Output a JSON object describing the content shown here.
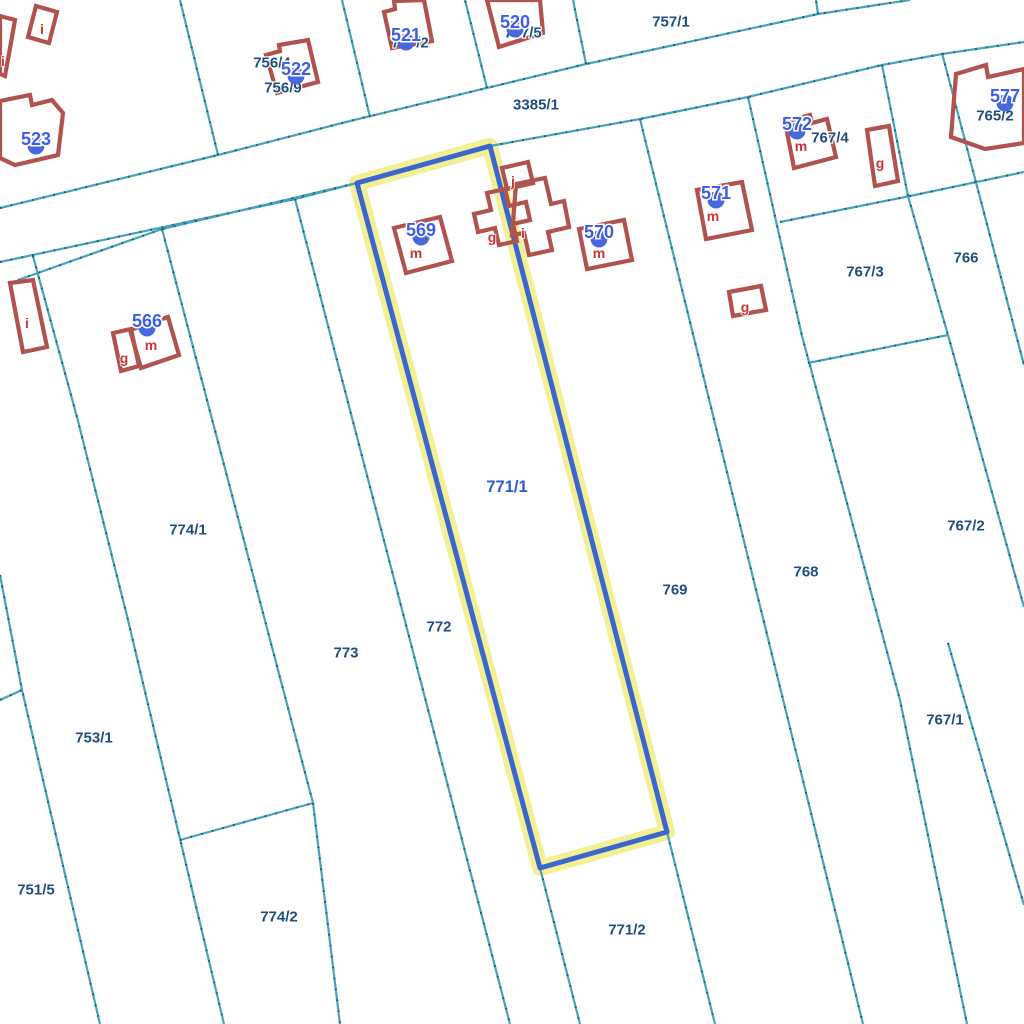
{
  "map": {
    "selected_parcel": "771/1",
    "colors": {
      "background": "#ffffff",
      "boundary": "#45a3bd",
      "boundary_speckle": "#104955",
      "building_stroke": "#b0524e",
      "letter_red": "#cc3434",
      "parcel_navy": "#1e4e7e",
      "selected_label_blue": "#2e5ad2",
      "house_number_blue": "#3e5de2",
      "house_marker_blue": "#4868e0",
      "highlight_blue": "#3a67cf",
      "highlight_halo": "#f2ee8f"
    },
    "highlight": {
      "parcel": "771/1",
      "points": [
        [
          357,
          183
        ],
        [
          490,
          146
        ],
        [
          667,
          832
        ],
        [
          540,
          868
        ]
      ]
    },
    "lines": [
      {
        "name": "road-top-edge",
        "points": [
          [
            0,
            208
          ],
          [
            218,
            155
          ],
          [
            350,
            121
          ],
          [
            586,
            64
          ],
          [
            818,
            14
          ],
          [
            910,
            0
          ]
        ]
      },
      {
        "name": "road-bottom-left",
        "points": [
          [
            0,
            262
          ],
          [
            295,
            199
          ],
          [
            357,
            183
          ]
        ]
      },
      {
        "name": "road-bottom-right",
        "points": [
          [
            490,
            146
          ],
          [
            640,
            119
          ],
          [
            748,
            97
          ],
          [
            882,
            65
          ],
          [
            942,
            54
          ],
          [
            1024,
            42
          ]
        ]
      },
      {
        "name": "verge-line",
        "points": [
          [
            18,
            280
          ],
          [
            162,
            229
          ],
          [
            353,
            184
          ]
        ]
      },
      {
        "name": "upper-bound-1",
        "points": [
          [
            218,
            155
          ],
          [
            180,
            0
          ]
        ]
      },
      {
        "name": "upper-bound-2",
        "points": [
          [
            370,
            117
          ],
          [
            342,
            0
          ]
        ]
      },
      {
        "name": "upper-bound-3",
        "points": [
          [
            487,
            88
          ],
          [
            465,
            0
          ]
        ]
      },
      {
        "name": "upper-bound-4",
        "points": [
          [
            586,
            64
          ],
          [
            573,
            0
          ]
        ]
      },
      {
        "name": "upper-bound-5",
        "points": [
          [
            818,
            14
          ],
          [
            816,
            0
          ]
        ]
      },
      {
        "name": "strip-751-753",
        "points": [
          [
            0,
            575
          ],
          [
            22,
            690
          ],
          [
            100,
            1024
          ]
        ]
      },
      {
        "name": "strip-751-spur",
        "points": [
          [
            0,
            700
          ],
          [
            22,
            690
          ]
        ]
      },
      {
        "name": "strip-753-774",
        "points": [
          [
            33,
            256
          ],
          [
            77,
            417
          ],
          [
            128,
            620
          ],
          [
            224,
            1024
          ]
        ]
      },
      {
        "name": "strip-774-773",
        "points": [
          [
            162,
            229
          ],
          [
            313,
            803
          ]
        ]
      },
      {
        "name": "cross-774-1-774-2",
        "points": [
          [
            180,
            840
          ],
          [
            313,
            803
          ]
        ]
      },
      {
        "name": "strip-7742-773",
        "points": [
          [
            313,
            803
          ],
          [
            340,
            1024
          ]
        ]
      },
      {
        "name": "strip-773-772",
        "points": [
          [
            295,
            199
          ],
          [
            510,
            1024
          ]
        ]
      },
      {
        "name": "strip-772-7712",
        "points": [
          [
            540,
            868
          ],
          [
            580,
            1024
          ]
        ]
      },
      {
        "name": "strip-7712-769",
        "points": [
          [
            667,
            832
          ],
          [
            715,
            1024
          ]
        ]
      },
      {
        "name": "strip-769-768",
        "points": [
          [
            640,
            119
          ],
          [
            863,
            1024
          ]
        ]
      },
      {
        "name": "strip-768-767",
        "points": [
          [
            748,
            97
          ],
          [
            802,
            336
          ],
          [
            900,
            700
          ],
          [
            967,
            1024
          ]
        ]
      },
      {
        "name": "cross-7674-7673",
        "points": [
          [
            780,
            222
          ],
          [
            910,
            196
          ],
          [
            1024,
            172
          ]
        ]
      },
      {
        "name": "strip-767-766",
        "points": [
          [
            882,
            65
          ],
          [
            908,
            196
          ],
          [
            948,
            335
          ],
          [
            1024,
            607
          ]
        ]
      },
      {
        "name": "strip-766-765",
        "points": [
          [
            942,
            53
          ],
          [
            1024,
            365
          ]
        ]
      },
      {
        "name": "cross-7673-7672",
        "points": [
          [
            808,
            363
          ],
          [
            948,
            335
          ]
        ]
      },
      {
        "name": "strip-7672-7671",
        "points": [
          [
            948,
            643
          ],
          [
            1024,
            905
          ]
        ]
      }
    ],
    "buildings": [
      {
        "name": "building-i-edge",
        "points": [
          [
            0,
            16
          ],
          [
            15,
            20
          ],
          [
            5,
            76
          ],
          [
            0,
            74
          ]
        ]
      },
      {
        "name": "building-i-small",
        "points": [
          [
            36,
            6
          ],
          [
            57,
            12
          ],
          [
            49,
            43
          ],
          [
            28,
            37
          ]
        ]
      },
      {
        "name": "building-523",
        "points": [
          [
            0,
            101
          ],
          [
            30,
            95
          ],
          [
            32,
            105
          ],
          [
            52,
            100
          ],
          [
            63,
            113
          ],
          [
            58,
            155
          ],
          [
            15,
            165
          ],
          [
            0,
            158
          ]
        ]
      },
      {
        "name": "building-i-long",
        "points": [
          [
            10,
            283
          ],
          [
            33,
            280
          ],
          [
            47,
            347
          ],
          [
            23,
            352
          ]
        ]
      },
      {
        "name": "building-566-main",
        "points": [
          [
            130,
            330
          ],
          [
            168,
            317
          ],
          [
            179,
            355
          ],
          [
            141,
            368
          ]
        ]
      },
      {
        "name": "building-566-g",
        "points": [
          [
            113,
            333
          ],
          [
            131,
            329
          ],
          [
            139,
            366
          ],
          [
            121,
            371
          ]
        ]
      },
      {
        "name": "building-522",
        "points": [
          [
            266,
            55
          ],
          [
            280,
            51
          ],
          [
            279,
            45
          ],
          [
            308,
            40
          ],
          [
            318,
            82
          ],
          [
            277,
            93
          ]
        ]
      },
      {
        "name": "building-521",
        "points": [
          [
            384,
            12
          ],
          [
            395,
            9
          ],
          [
            394,
            1
          ],
          [
            424,
            0
          ],
          [
            432,
            41
          ],
          [
            392,
            48
          ]
        ]
      },
      {
        "name": "building-520",
        "points": [
          [
            487,
            0
          ],
          [
            540,
            0
          ],
          [
            543,
            33
          ],
          [
            499,
            47
          ]
        ]
      },
      {
        "name": "building-569",
        "points": [
          [
            394,
            228
          ],
          [
            440,
            217
          ],
          [
            452,
            261
          ],
          [
            406,
            273
          ]
        ]
      },
      {
        "name": "building-j",
        "points": [
          [
            502,
            168
          ],
          [
            528,
            162
          ],
          [
            533,
            183
          ],
          [
            507,
            189
          ]
        ]
      },
      {
        "name": "building-cross-g",
        "points": [
          [
            487,
            193
          ],
          [
            505,
            189
          ],
          [
            509,
            206
          ],
          [
            526,
            202
          ],
          [
            530,
            220
          ],
          [
            513,
            224
          ],
          [
            517,
            241
          ],
          [
            499,
            245
          ],
          [
            495,
            228
          ],
          [
            478,
            232
          ],
          [
            474,
            214
          ],
          [
            491,
            210
          ]
        ]
      },
      {
        "name": "building-i-part",
        "points": [
          [
            516,
            184
          ],
          [
            545,
            178
          ],
          [
            551,
            204
          ],
          [
            564,
            201
          ],
          [
            569,
            227
          ],
          [
            548,
            232
          ],
          [
            552,
            250
          ],
          [
            529,
            255
          ],
          [
            524,
            233
          ],
          [
            512,
            235
          ]
        ]
      },
      {
        "name": "building-570",
        "points": [
          [
            579,
            229
          ],
          [
            624,
            220
          ],
          [
            632,
            260
          ],
          [
            587,
            269
          ]
        ]
      },
      {
        "name": "building-571",
        "points": [
          [
            697,
            190
          ],
          [
            742,
            182
          ],
          [
            752,
            230
          ],
          [
            706,
            239
          ]
        ]
      },
      {
        "name": "building-571-g",
        "points": [
          [
            729,
            292
          ],
          [
            761,
            286
          ],
          [
            766,
            310
          ],
          [
            733,
            316
          ]
        ]
      },
      {
        "name": "building-572",
        "points": [
          [
            785,
            122
          ],
          [
            810,
            115
          ],
          [
            812,
            123
          ],
          [
            827,
            119
          ],
          [
            836,
            157
          ],
          [
            794,
            168
          ]
        ]
      },
      {
        "name": "building-572-g",
        "points": [
          [
            867,
            130
          ],
          [
            889,
            126
          ],
          [
            898,
            181
          ],
          [
            875,
            186
          ]
        ]
      },
      {
        "name": "building-577",
        "points": [
          [
            956,
            74
          ],
          [
            986,
            65
          ],
          [
            988,
            77
          ],
          [
            1024,
            69
          ],
          [
            1024,
            143
          ],
          [
            985,
            149
          ],
          [
            951,
            137
          ]
        ]
      }
    ],
    "building_letters": [
      {
        "text": "i",
        "x": 3,
        "y": 61
      },
      {
        "text": "i",
        "x": 42,
        "y": 29
      },
      {
        "text": "i",
        "x": 27,
        "y": 323
      },
      {
        "text": "g",
        "x": 124,
        "y": 358
      },
      {
        "text": "m",
        "x": 151,
        "y": 345
      },
      {
        "text": "m",
        "x": 416,
        "y": 253
      },
      {
        "text": "g",
        "x": 492,
        "y": 237
      },
      {
        "text": "i",
        "x": 523,
        "y": 233
      },
      {
        "text": "j",
        "x": 513,
        "y": 181
      },
      {
        "text": "m",
        "x": 599,
        "y": 253
      },
      {
        "text": "m",
        "x": 713,
        "y": 216
      },
      {
        "text": "g",
        "x": 745,
        "y": 307
      },
      {
        "text": "m",
        "x": 801,
        "y": 146
      },
      {
        "text": "g",
        "x": 880,
        "y": 163
      }
    ],
    "parcel_labels": [
      {
        "text": "756/9",
        "x": 283,
        "y": 88,
        "accent": false
      },
      {
        "text": "756/4",
        "x": 272,
        "y": 63,
        "accent": false
      },
      {
        "text": "757/2",
        "x": 410,
        "y": 43,
        "accent": false
      },
      {
        "text": "757/5",
        "x": 523,
        "y": 33,
        "accent": false
      },
      {
        "text": "757/1",
        "x": 671,
        "y": 22,
        "accent": false
      },
      {
        "text": "3385/1",
        "x": 536,
        "y": 105,
        "accent": false
      },
      {
        "text": "765/2",
        "x": 995,
        "y": 116,
        "accent": false
      },
      {
        "text": "767/4",
        "x": 830,
        "y": 138,
        "accent": false
      },
      {
        "text": "767/3",
        "x": 865,
        "y": 272,
        "accent": false
      },
      {
        "text": "766",
        "x": 966,
        "y": 258,
        "accent": false
      },
      {
        "text": "767/2",
        "x": 966,
        "y": 526,
        "accent": false
      },
      {
        "text": "767/1",
        "x": 945,
        "y": 720,
        "accent": false
      },
      {
        "text": "768",
        "x": 806,
        "y": 572,
        "accent": false
      },
      {
        "text": "769",
        "x": 675,
        "y": 590,
        "accent": false
      },
      {
        "text": "771/1",
        "x": 507,
        "y": 487,
        "accent": true
      },
      {
        "text": "772",
        "x": 439,
        "y": 627,
        "accent": false
      },
      {
        "text": "773",
        "x": 346,
        "y": 653,
        "accent": false
      },
      {
        "text": "774/1",
        "x": 188,
        "y": 530,
        "accent": false
      },
      {
        "text": "774/2",
        "x": 279,
        "y": 917,
        "accent": false
      },
      {
        "text": "753/1",
        "x": 94,
        "y": 738,
        "accent": false
      },
      {
        "text": "751/5",
        "x": 36,
        "y": 890,
        "accent": false
      },
      {
        "text": "771/2",
        "x": 627,
        "y": 930,
        "accent": false
      }
    ],
    "house_numbers": [
      {
        "text": "523",
        "x": 36,
        "y": 139
      },
      {
        "text": "522",
        "x": 296,
        "y": 69
      },
      {
        "text": "521",
        "x": 406,
        "y": 35
      },
      {
        "text": "520",
        "x": 515,
        "y": 22
      },
      {
        "text": "566",
        "x": 147,
        "y": 321
      },
      {
        "text": "569",
        "x": 421,
        "y": 230
      },
      {
        "text": "570",
        "x": 599,
        "y": 232
      },
      {
        "text": "571",
        "x": 716,
        "y": 193
      },
      {
        "text": "572",
        "x": 797,
        "y": 124
      },
      {
        "text": "577",
        "x": 1005,
        "y": 96
      }
    ]
  }
}
